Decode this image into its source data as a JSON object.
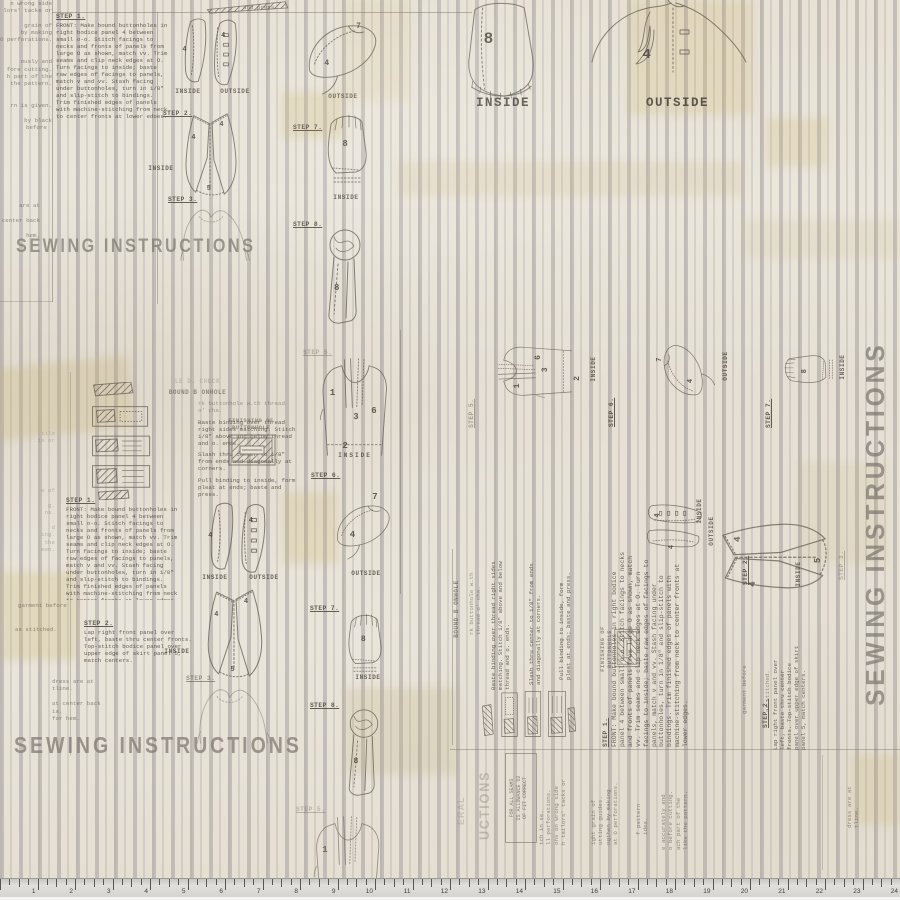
{
  "colors": {
    "ground": "#e9e4d8",
    "stripe_gray": "#8c868c",
    "ink": "#57504a",
    "heading_gray": "#7d7770",
    "ruler_bg": "#d8d6d2"
  },
  "fabric": {
    "headings": {
      "main": "SEWING INSTRUCTIONS",
      "fragment": "UCTIONS",
      "general_fragment": "ERAL"
    },
    "labels": {
      "inside": "INSIDE",
      "outside": "OUTSIDE",
      "press": "and press."
    },
    "steps": {
      "s1": "STEP 1.",
      "s2": "STEP 2.",
      "s3": "STEP 3.",
      "s5": "STEP 5.",
      "s6": "STEP 6.",
      "s7": "STEP 7.",
      "s8": "STEP 8."
    },
    "numerals": {
      "n1": "1",
      "n2": "2",
      "n3": "3",
      "n4": "4",
      "n5": "5",
      "n6": "6",
      "n7": "7",
      "n8": "8"
    },
    "step1_body": "FRONT: Make bound buttonholes in right bodice panel 4 between small o-o. Stitch facings to necks and fronts of panels from large O as shown, match vv. Trim seams and clip neck edges at O. Turn facings to inside; baste raw edges of facings to panels, match v and vv. Stash facing under buttonholes, turn in 1/8\" and slip-stitch to bindings. Trim finished edges of panels with machine-stitching from neck to center fronts at lower edges.",
    "step2_body": "Lap right front panel over left, baste thru center fronts. Top-stitch bodice panel over upper edge of skirt panel 5, match centers.",
    "buttonhole": {
      "title_faint": "LE D. CHECK",
      "title": "BOUND B  ONHOLE",
      "intro": "rk buttonhole w.th thread o' cha.",
      "baste": "Baste binding over thread right sides matching. Stitch 1/8\" above and below thread and o. ends.",
      "slash": "Slash thru center to 1/8\" from ends and diagonally at corners.",
      "pull": "Pull binding to inside, form pleat at ends; baste and press.",
      "finishing_1": "FINISHING OF",
      "finishing_2": "BUTTONHOLE"
    },
    "fit_note": [
      "FOR ALL SEAMS",
      "IS ALLOWANCE O2",
      "OF FIT CORRECT"
    ],
    "margins": {
      "col_a": [
        "n wrong side",
        "lors' tacks or",
        "",
        "grain of",
        "by making",
        "O perforations.",
        "",
        "",
        "ously and",
        "fore cutting.",
        "h part of the",
        "the pattern.",
        "",
        "",
        "rn is given.",
        "",
        "by black"
      ],
      "before": "before",
      "col_b": [
        "are at",
        "",
        "center back",
        "",
        "hem."
      ],
      "col_c0": [
        "tile",
        "is or"
      ],
      "col_c": [
        "s of",
        "",
        "g.",
        "ns.",
        "",
        "d",
        "ing.",
        "the",
        "een."
      ],
      "garment": "garment before",
      "stitched": "as stitched.",
      "col_d": [
        "dress are at",
        "tline.",
        "",
        "at center back",
        "is.",
        "for hem."
      ],
      "cut_frags": [
        "tch in se.",
        "ll perforations.",
        "ons on wrong side",
        "h tailors' tacks or"
      ],
      "grain_frags": [
        "ight grain of",
        "utting guides.",
        "ngthen by making",
        "at O perforations."
      ],
      "pattern_frags": [
        "f pattern",
        "idea."
      ],
      "accurate_frags": [
        "e accurately and",
        "o before cutting.",
        "ach part of the",
        "like the pattern."
      ]
    }
  },
  "ruler": {
    "inches": 24,
    "numbers": [
      "1",
      "2",
      "3",
      "4",
      "5",
      "6",
      "7",
      "8",
      "9",
      "10",
      "11",
      "12",
      "13",
      "14",
      "15",
      "16",
      "17",
      "18",
      "19",
      "20",
      "21",
      "22",
      "23",
      "24"
    ]
  }
}
